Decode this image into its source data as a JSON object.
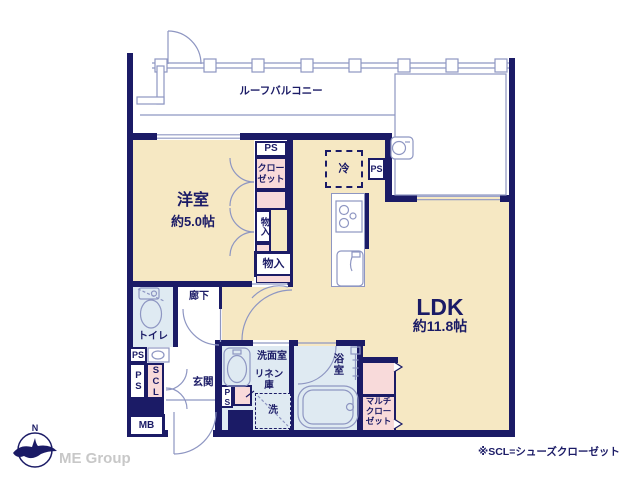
{
  "colors": {
    "wall_navy": "#1b1b66",
    "room_beige": "#f6e8c3",
    "closet_pink": "#f8dada",
    "wet_area_blue": "#dfeaf2",
    "thin_line_blue": "#8e96c2",
    "logo_gray": "#c8c8c8"
  },
  "balcony": {
    "label": "ルーフバルコニー"
  },
  "rooms": {
    "western": {
      "name": "洋室",
      "size": "約5.0帖"
    },
    "ldk": {
      "name": "LDK",
      "size": "約11.8帖"
    },
    "toilet": {
      "name": "トイレ"
    },
    "hallway": {
      "name": "廊下"
    },
    "entrance": {
      "name": "玄関"
    },
    "washroom": {
      "name": "洗面室"
    },
    "bathroom": {
      "name": "浴室"
    }
  },
  "fixtures": {
    "closet": "クローゼット",
    "storage_upper": "物入",
    "storage_lower": "物入",
    "fridge": "冷",
    "linen": "リネン庫",
    "washer": "洗",
    "multi_closet": "マルチクローゼット",
    "shoes_closet": "SCL",
    "meter_box": "MB",
    "ps_closet_top": "PS",
    "ps_kitchen": "PS",
    "ps_toilet": "PS",
    "ps_hall": "PS",
    "ps_washroom": "PS"
  },
  "note": "※SCL=シューズクローゼット",
  "logo": {
    "company": "ME Group",
    "compass_north": "N"
  }
}
